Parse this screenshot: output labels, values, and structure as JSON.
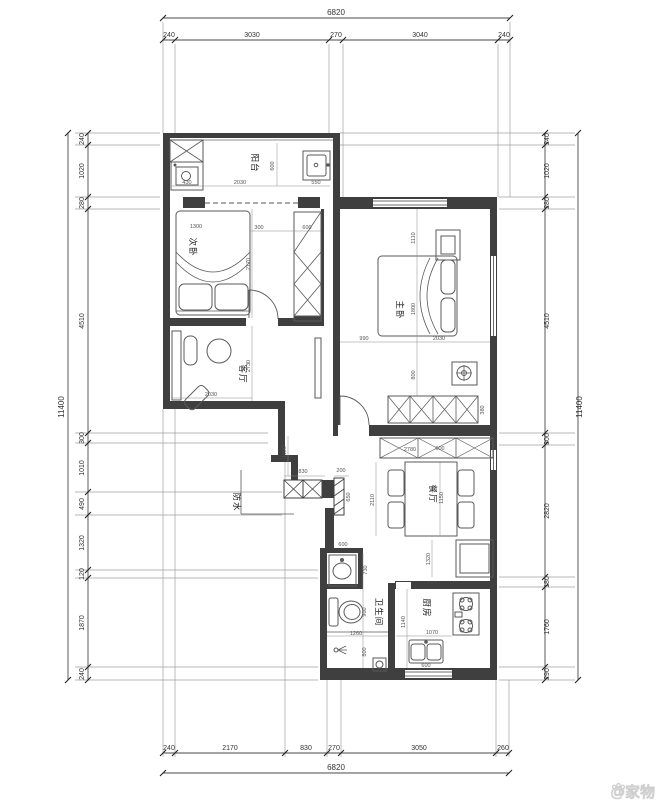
{
  "watermark": {
    "text": "@家物"
  },
  "rooms": {
    "balcony": "阳台",
    "bedroom2": "次卧",
    "living": "客厅",
    "master": "主卧",
    "dining": "餐厅",
    "bathroom": "卫生间",
    "kitchen": "厨房"
  },
  "annotation": {
    "waterproof": "防水"
  },
  "dims": {
    "top_total": "6820",
    "top": [
      "240",
      "3030",
      "270",
      "3040",
      "240"
    ],
    "bottom_total": "6820",
    "bottom": [
      "240",
      "2170",
      "830",
      "270",
      "3050",
      "260"
    ],
    "left_total": "11400",
    "left": [
      "240",
      "1020",
      "280",
      "4510",
      "300",
      "1010",
      "490",
      "1320",
      "120",
      "1870",
      "240"
    ],
    "right_total": "11400",
    "right": [
      "240",
      "1020",
      "280",
      "4510",
      "300",
      "2820",
      "180",
      "1760",
      "290"
    ],
    "interior": {
      "balcony_washer": "430",
      "balcony_width": "2030",
      "balcony_sink": "550",
      "balcony_depth": "600",
      "bed2_width": "1300",
      "bed2_length": "2170",
      "bed2_gap": "300",
      "bed2_closet": "600",
      "living_depth": "2730",
      "living_width": "2030",
      "master_left": "990",
      "master_bed": "2030",
      "master_top": "1110",
      "master_mid": "1800",
      "master_low": "800",
      "master_wardrobe": "380",
      "hall_v": "1100",
      "hall_w": "830",
      "hall_opening": "200",
      "hall_side": "650",
      "dining_cab_a": "2780",
      "dining_cab_b": "600",
      "dining_depth": "1150",
      "dining_width": "2110",
      "fridge_gap": "1320",
      "bath_basin": "600",
      "bath_basin_d": "730",
      "bath_toilet": "900",
      "bath_width": "1260",
      "bath_shower": "800",
      "kitchen_w": "1070",
      "kitchen_d": "1140",
      "kitchen_sink": "600"
    }
  }
}
